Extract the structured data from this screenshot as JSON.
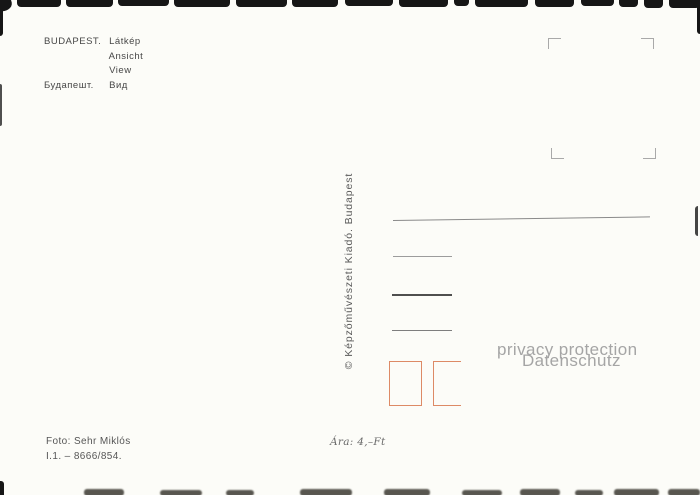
{
  "card": {
    "header": {
      "city": "BUDAPEST.",
      "caption_hu": "Látkép",
      "caption_de": "Ansicht",
      "caption_en": "View",
      "city_ru": "Будапешт.",
      "caption_ru": "Вид"
    },
    "publisher": "©  Képzőművészeti Kiadó. Budapest",
    "watermark": {
      "line1": "privacy protection",
      "line2": "Datenschutz"
    },
    "footer": {
      "photo_credit": "Foto: Sehr Miklós",
      "serial": "I.1. – 8666/854.",
      "price": "Ára: 4,–Ft"
    },
    "colors": {
      "ink": "#474747",
      "line_gray": "#8a8a8a",
      "stamp_box_accent": "#dd8a66",
      "watermark_gray": "#a5a5a5"
    }
  }
}
